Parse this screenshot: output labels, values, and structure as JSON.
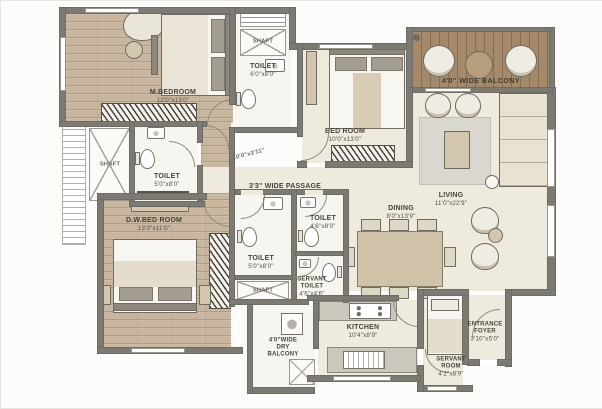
{
  "rooms": {
    "m_bedroom": {
      "name": "M.BEDROOM",
      "dims": "12'0\"x13'0\""
    },
    "toilet_m": {
      "name": "TOILET",
      "dims": "6'0\"x8'0\""
    },
    "bed_room": {
      "name": "BED ROOM",
      "dims": "10'0\"x13'0\""
    },
    "balcony": {
      "name": "4'0\" WIDE BALCONY"
    },
    "living": {
      "name": "LIVING",
      "dims": "11'0\"x22'9\""
    },
    "dining": {
      "name": "DINING",
      "dims": "8'0\"x13'9\""
    },
    "passage": {
      "name": "3'3\" WIDE PASSAGE",
      "dims": "10'0\"x3'11\""
    },
    "dw_bedroom": {
      "name": "D.W.BED ROOM",
      "dims": "13'0\"x11'0\""
    },
    "toilet_dw": {
      "name": "TOILET",
      "dims": "5'0\"x8'0\""
    },
    "toilet_common": {
      "name": "TOILET",
      "dims": "5'0\"x8'0\""
    },
    "toilet_bed2": {
      "name": "TOILET",
      "dims": "4'6\"x8'0\""
    },
    "servant_toilet": {
      "line1": "SERVANT",
      "line2": "TOILET",
      "dims": "4'6\"x4'6\""
    },
    "kitchen": {
      "name": "KITCHEN",
      "dims": "10'4\"x8'9\""
    },
    "dry_balcony": {
      "line1": "4'0\"WIDE",
      "line2": "DRY",
      "line3": "BALCONY"
    },
    "servant_room": {
      "line1": "SERVANT",
      "line2": "ROOM",
      "dims": "4'2\"x8'9\""
    },
    "entrance": {
      "line1": "ENTRANCE",
      "line2": "FOYER",
      "dims": "3'10\"x5'0\""
    },
    "shaft": {
      "name": "SHAFT"
    }
  },
  "colors": {
    "wall": "#7d7a74",
    "wood": "#c9b69e",
    "deck": "#a5896b",
    "floor": "#efeade",
    "floor_light": "#f7f5ef",
    "accent": "#d3c6ae",
    "furniture_outline": "#6f6b61"
  }
}
